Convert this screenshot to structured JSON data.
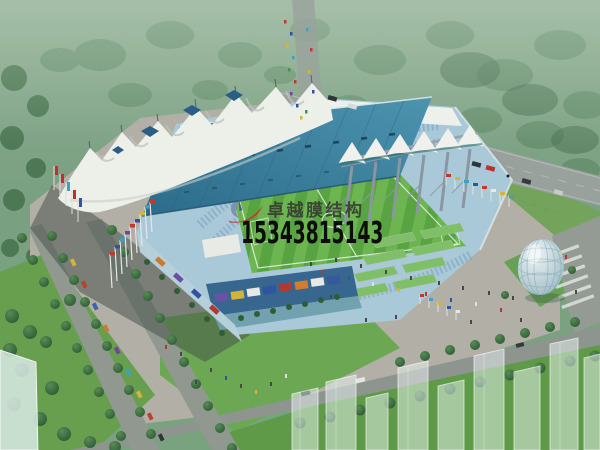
{
  "watermark": {
    "company_name": "卓越膜结构",
    "phone_number": "15343815143",
    "logo_icon": "brand-swoosh-logo",
    "colors": {
      "company_text": "#34342f",
      "phone_text": "#0d0d0d",
      "logo_red": "#c0392b",
      "logo_blue": "#7c93ab"
    }
  },
  "scene": {
    "subject": "tensile-membrane-stadium-aerial-rendering",
    "palette": {
      "forest_green": "#4e7c56",
      "mist_green": "#8aa98e",
      "lawn_green": "#6ca853",
      "pitch_green_dark": "#58a342",
      "pitch_green_light": "#6db551",
      "roof_teal": "#3f87a3",
      "membrane_white": "#edefe9",
      "stands_blue": "#a9c8d8",
      "plaza_gray": "#b1afa6",
      "road_gray": "#98a19b",
      "fountain_blue": "#8ec9de",
      "shadow_gray": "#434e48",
      "dome_glass": "#bcd3da"
    }
  }
}
